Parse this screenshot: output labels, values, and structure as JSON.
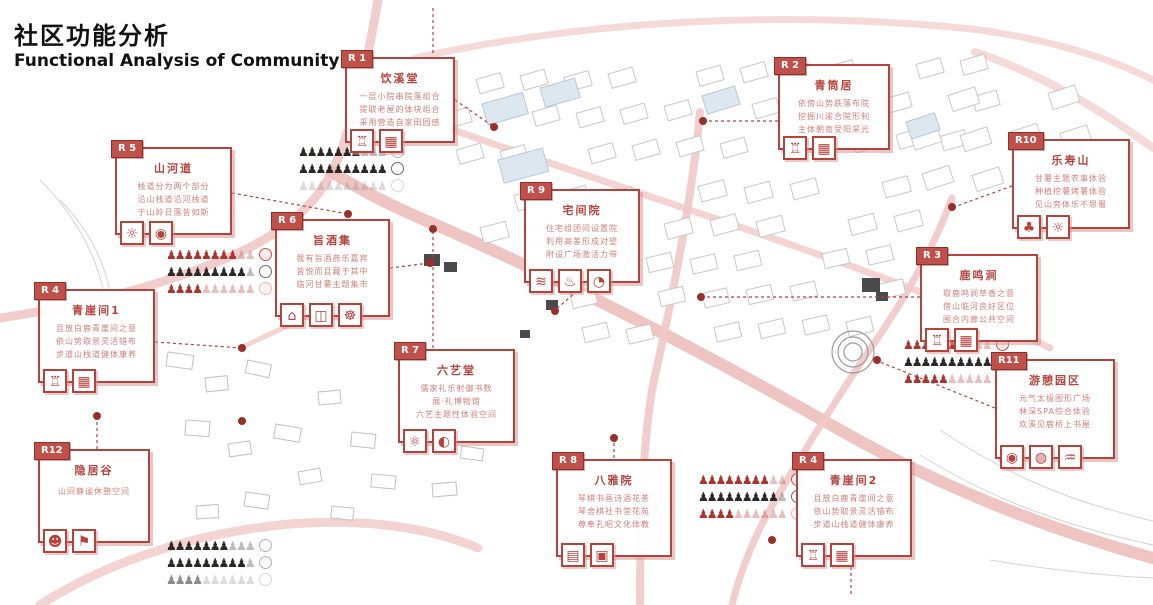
{
  "header": {
    "title_zh": "社区功能分析",
    "title_en": "Functional Analysis of Community"
  },
  "colors": {
    "accent_red": "#b4433d",
    "tag_background": "#c0504a",
    "body_text_red": "#d07f7a",
    "crowd_red": "#a93530",
    "crowd_black": "#2c2826",
    "road_pink": "#f0c9c8",
    "dot_red": "#97302b"
  },
  "callouts": [
    {
      "id": "r1",
      "tag": "R 1",
      "title": "饮溪堂",
      "lines": [
        "一层小院串院落组合",
        "提取老屋的体块组合",
        "采用营造自家田园感"
      ],
      "icons": [
        {
          "name": "temple-icon",
          "glyph": "♖"
        },
        {
          "name": "lattice-icon",
          "glyph": "▦"
        }
      ]
    },
    {
      "id": "r2",
      "tag": "R 2",
      "title": "青筒居",
      "lines": [
        "依傍山势跌落布院",
        "挖掘川渝合院形制",
        "主体朝南受阳采光"
      ],
      "icons": [
        {
          "name": "temple-icon",
          "glyph": "♖"
        },
        {
          "name": "lattice-icon",
          "glyph": "▦"
        }
      ]
    },
    {
      "id": "r10",
      "tag": "R10",
      "title": "乐寿山",
      "lines": [
        "甘薯主题农事体验",
        "种植挖薯烤薯体验",
        "见山旁体乐不思蜀"
      ],
      "icons": [
        {
          "name": "tree-icon",
          "glyph": "♣"
        },
        {
          "name": "sun-icon",
          "glyph": "☼"
        }
      ]
    },
    {
      "id": "r5",
      "tag": "R 5",
      "title": "山河道",
      "lines": [
        "栈道分为两个部分",
        "沿山栈道沿河栈道",
        "于山岭日落皆如斯"
      ],
      "icons": [
        {
          "name": "sun-icon",
          "glyph": "☼"
        },
        {
          "name": "camera-icon",
          "glyph": "◉"
        }
      ]
    },
    {
      "id": "r6",
      "tag": "R 6",
      "title": "旨酒集",
      "lines": [
        "我有旨酒燕乐嘉宾",
        "皆悦而且藏于其中",
        "临河甘薯主题集市"
      ],
      "icons": [
        {
          "name": "market-stall-icon",
          "glyph": "⌂"
        },
        {
          "name": "wine-jar-icon",
          "glyph": "◫"
        },
        {
          "name": "fan-icon",
          "glyph": "☸"
        }
      ]
    },
    {
      "id": "r4a",
      "tag": "R 4",
      "title": "青崖间1",
      "lines": [
        "且放白鹿青崖间之意",
        "依山势取景灵活错布",
        "步道山栈道健体康养"
      ],
      "icons": [
        {
          "name": "temple-icon",
          "glyph": "♖"
        },
        {
          "name": "lattice-icon",
          "glyph": "▦"
        }
      ]
    },
    {
      "id": "r9",
      "tag": "R 9",
      "title": "宅间院",
      "lines": [
        "住宅组团间设置院",
        "利用高差形成对望",
        "附设广场激活力带"
      ],
      "icons": [
        {
          "name": "signal-icon",
          "glyph": "≋"
        },
        {
          "name": "fountain-icon",
          "glyph": "♨"
        },
        {
          "name": "plate-icon",
          "glyph": "◔"
        }
      ]
    },
    {
      "id": "r3",
      "tag": "R 3",
      "title": "鹿鸣涧",
      "lines": [
        "取鹿鸣涧草香之意",
        "傍山临河良好区位",
        "围合内廊公共空间"
      ],
      "icons": [
        {
          "name": "temple-icon",
          "glyph": "♖"
        },
        {
          "name": "lattice-icon",
          "glyph": "▦"
        }
      ]
    },
    {
      "id": "r7",
      "tag": "R 7",
      "title": "六艺堂",
      "lines": [
        "儒家礼乐射御书数",
        "展·礼博物馆",
        "六艺主题性体验空间"
      ],
      "icons": [
        {
          "name": "atom-icon",
          "glyph": "⚛"
        },
        {
          "name": "moon-icon",
          "glyph": "◐"
        }
      ]
    },
    {
      "id": "r11",
      "tag": "R11",
      "title": "游憩园区",
      "lines": [
        "元气太极图形广场",
        "林深SPA综合体验",
        "欢溪见鹿桥上书屋"
      ],
      "icons": [
        {
          "name": "camera-icon",
          "glyph": "◉"
        },
        {
          "name": "spa-icon",
          "glyph": "◍"
        },
        {
          "name": "wind-icon",
          "glyph": "♒"
        }
      ]
    },
    {
      "id": "r12",
      "tag": "R12",
      "title": "隐居谷",
      "lines": [
        "山间静谧休憩空间"
      ],
      "icons": [
        {
          "name": "panda-icon",
          "glyph": "☻"
        },
        {
          "name": "signpost-icon",
          "glyph": "⚑"
        }
      ]
    },
    {
      "id": "r8",
      "tag": "R 8",
      "title": "八雅院",
      "lines": [
        "琴棋书画诗酒花茶",
        "琴舍棋社书堂花苑",
        "尊奉孔昭文化体教"
      ],
      "icons": [
        {
          "name": "abacus-icon",
          "glyph": "▤"
        },
        {
          "name": "screen-icon",
          "glyph": "▣"
        }
      ]
    },
    {
      "id": "r4b",
      "tag": "R 4",
      "title": "青崖间2",
      "lines": [
        "且放白鹿青崖间之意",
        "依山势取景灵活错布",
        "步道山栈道健体康养"
      ],
      "icons": [
        {
          "name": "temple-icon",
          "glyph": "♖"
        },
        {
          "name": "lattice-icon",
          "glyph": "▦"
        }
      ]
    }
  ],
  "crowd_groups": [
    {
      "id": "near-r1",
      "rows": [
        {
          "tone": "black",
          "solid": "♟♟♟♟♟♟♟",
          "faint": "♟♟♟",
          "circle": "gray"
        },
        {
          "tone": "black",
          "solid": "♟♟♟♟♟♟♟♟♟♟",
          "faint": "",
          "circle": "black"
        },
        {
          "tone": "gray",
          "solid": "",
          "faint": "♟♟♟♟♟♟♟♟♟♟",
          "circle": "faint-gray"
        }
      ]
    },
    {
      "id": "near-r6",
      "rows": [
        {
          "tone": "red",
          "solid": "♟♟♟♟♟♟♟♟",
          "faint": "♟♟",
          "circle": "red"
        },
        {
          "tone": "black",
          "solid": "♟♟♟♟♟♟♟♟♟",
          "faint": "♟",
          "circle": "black"
        },
        {
          "tone": "red",
          "solid": "♟♟♟♟",
          "faint": "♟♟♟♟♟♟",
          "circle": "faint-red"
        }
      ]
    },
    {
      "id": "near-r3",
      "rows": [
        {
          "tone": "red",
          "solid": "♟♟♟♟♟♟♟",
          "faint": "♟♟♟",
          "circle": "red"
        },
        {
          "tone": "black",
          "solid": "♟♟♟♟♟♟♟♟♟♟",
          "faint": "",
          "circle": "black"
        },
        {
          "tone": "red",
          "solid": "♟♟♟♟♟",
          "faint": "♟♟♟♟♟",
          "circle": "faint-red"
        }
      ]
    },
    {
      "id": "near-r8",
      "rows": [
        {
          "tone": "red",
          "solid": "♟♟♟♟♟♟♟♟",
          "faint": "♟♟",
          "circle": "red"
        },
        {
          "tone": "black",
          "solid": "♟♟♟♟♟♟♟♟♟",
          "faint": "♟",
          "circle": "black"
        },
        {
          "tone": "red",
          "solid": "♟♟♟♟",
          "faint": "♟♟♟♟♟♟",
          "circle": "faint-red"
        }
      ]
    },
    {
      "id": "bottom-left",
      "rows": [
        {
          "tone": "black",
          "solid": "♟♟♟♟♟♟♟",
          "faint": "♟♟♟",
          "circle": "gray"
        },
        {
          "tone": "black",
          "solid": "♟♟♟♟♟♟♟♟♟",
          "faint": "♟",
          "circle": "gray"
        },
        {
          "tone": "gray",
          "solid": "♟♟♟♟",
          "faint": "♟♟♟♟♟♟",
          "circle": "faint-gray"
        }
      ]
    }
  ]
}
